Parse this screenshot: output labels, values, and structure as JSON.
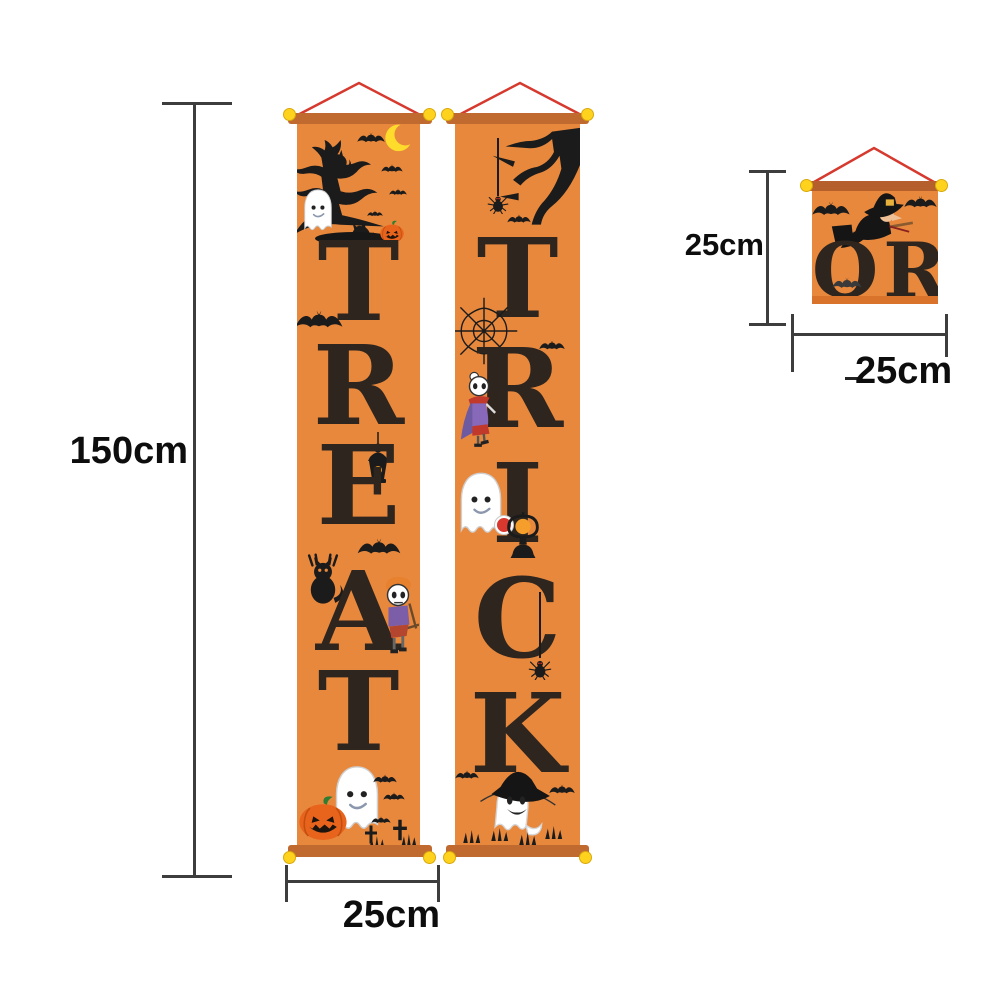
{
  "banners": {
    "treat": {
      "word": "TREAT",
      "letters": [
        "T",
        "R",
        "E",
        "A",
        "T"
      ],
      "icons": [
        "spooky-tree",
        "black-cat",
        "crescent-moon",
        "bat",
        "ghost",
        "jack-o-lantern",
        "hanging-lantern",
        "hanging-black-cat",
        "skeleton-boy",
        "grave-cross",
        "grass-tuft"
      ]
    },
    "trick": {
      "word": "TRICK",
      "letters": [
        "T",
        "R",
        "I",
        "C",
        "K"
      ],
      "icons": [
        "dead-branch",
        "hanging-spider",
        "bat",
        "spider-web",
        "skeleton-witch",
        "candy-ghost",
        "lantern",
        "spider",
        "witch-hat-ghost",
        "grass-tuft"
      ]
    },
    "or_sign": {
      "word": "OR",
      "letters": [
        "O",
        "R"
      ],
      "icons": [
        "witch-on-broomstick",
        "bat"
      ]
    }
  },
  "measurements": {
    "banner_height": "150cm",
    "banner_width": "25cm",
    "sign_height": "25cm",
    "sign_width": "25cm"
  },
  "colors": {
    "banner_orange": "#e8883d",
    "rod_orange": "#c06a2f",
    "sign_rod_brown": "#b55f2d",
    "string_red": "#d6392e",
    "cap_yellow": "#ffd21e",
    "letter_black": "#2e251e",
    "dimension_line": "#3d3d3d"
  }
}
